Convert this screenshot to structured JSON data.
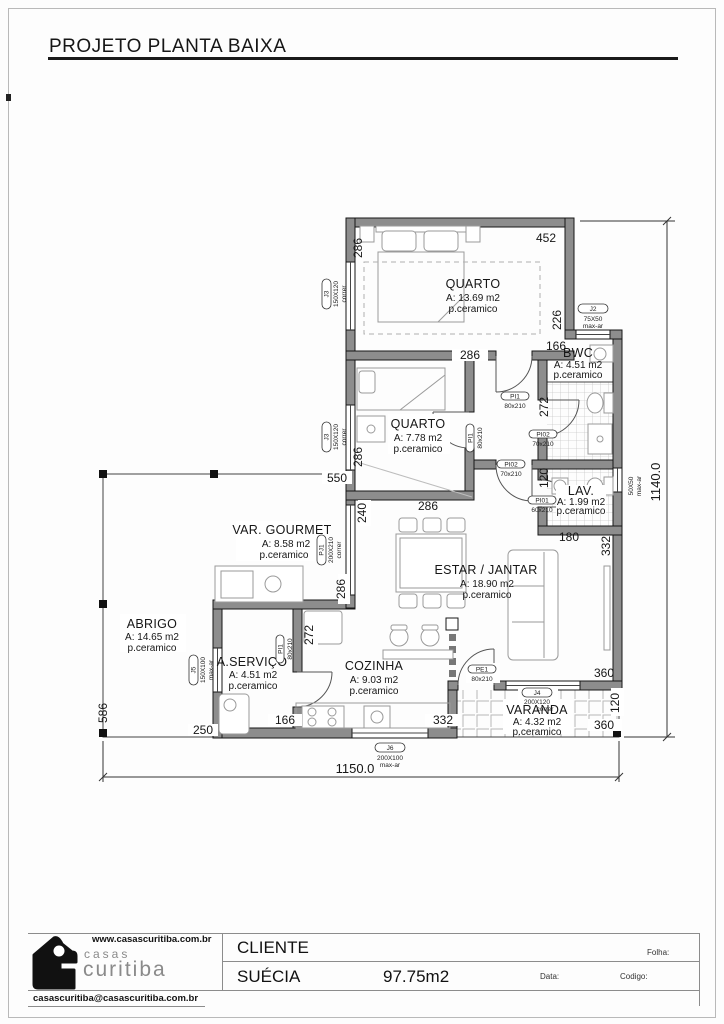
{
  "page": {
    "title": "PROJETO PLANTA BAIXA"
  },
  "plan": {
    "rooms": {
      "quarto1": {
        "name": "QUARTO",
        "area": "A: 13.69 m2",
        "floor": "p.ceramico"
      },
      "quarto2": {
        "name": "QUARTO",
        "area": "A: 7.78 m2",
        "floor": "p.ceramico"
      },
      "bwc": {
        "name": "BWC",
        "area": "A: 4.51 m2",
        "floor": "p.ceramico"
      },
      "lav": {
        "name": "LAV.",
        "area": "A: 1.99 m2",
        "floor": "p.ceramico"
      },
      "estar": {
        "name": "ESTAR / JANTAR",
        "area": "A: 18.90 m2",
        "floor": "p.ceramico"
      },
      "var_gourmet": {
        "name": "VAR. GOURMET",
        "area": "A: 8.58 m2",
        "floor": "p.ceramico"
      },
      "abrigo": {
        "name": "ABRIGO",
        "area": "A: 14.65 m2",
        "floor": "p.ceramico"
      },
      "a_servico": {
        "name": "A.SERVIÇO",
        "area": "A: 4.51 m2",
        "floor": "p.ceramico"
      },
      "cozinha": {
        "name": "COZINHA",
        "area": "A: 9.03 m2",
        "floor": "p.ceramico"
      },
      "varanda": {
        "name": "VARANDA",
        "area": "A: 4.32 m2",
        "floor": "p.ceramico"
      }
    },
    "dims": {
      "d452": "452",
      "d286a": "286",
      "d226": "226",
      "d166bwc": "166",
      "d272bwc": "272",
      "d286b": "286",
      "d286c": "286",
      "d286d": "286",
      "d240": "240",
      "d550": "550",
      "d286e": "286",
      "d120lav": "120",
      "d180": "180",
      "d332estar": "332",
      "d272coz": "272",
      "d166serv": "166",
      "d332coz": "332",
      "d586": "586",
      "d250": "250",
      "d360a": "360",
      "d120var": "120",
      "d360b": "360",
      "total_w": "1150.0",
      "total_h": "1140.0"
    },
    "openings": {
      "j3a": {
        "tag": "J3",
        "size": "150X120",
        "type": "correr"
      },
      "j3b": {
        "tag": "J3",
        "size": "150X120",
        "type": "correr"
      },
      "j2": {
        "tag": "J2",
        "size": "75X50",
        "type": "max-ar"
      },
      "j1": {
        "size": "50X50",
        "type": "max-ar"
      },
      "pj1": {
        "tag": "PJ1",
        "size": "200X210",
        "type": "correr"
      },
      "j5": {
        "tag": "J5",
        "size": "150X100",
        "type": "max-ar"
      },
      "j6": {
        "tag": "J6",
        "size": "200X100",
        "type": "max-ar"
      },
      "j4": {
        "tag": "J4",
        "size": "200X120",
        "type": "correr"
      },
      "pi1a": {
        "tag": "PI1",
        "size": "80x210"
      },
      "pi1b": {
        "tag": "PI1",
        "size": "80x210"
      },
      "pi1c": {
        "tag": "PI1",
        "size": "80x210"
      },
      "pi02a": {
        "tag": "PI02",
        "size": "70x210"
      },
      "pi02b": {
        "tag": "PI02",
        "size": "70x210"
      },
      "pi01": {
        "tag": "PI01",
        "size": "60x210"
      },
      "pe1": {
        "tag": "PE1",
        "size": "80x210"
      }
    }
  },
  "titleblock": {
    "website": "www.casascuritiba.com.br",
    "email": "casascuritiba@casascuritiba.com.br",
    "logo_line1": "casas",
    "logo_line2": "curitiba",
    "client_label": "CLIENTE",
    "client_value": "SUÉCIA",
    "area_total": "97.75m2",
    "folha_label": "Folha:",
    "data_label": "Data:",
    "codigo_label": "Codigo:"
  }
}
